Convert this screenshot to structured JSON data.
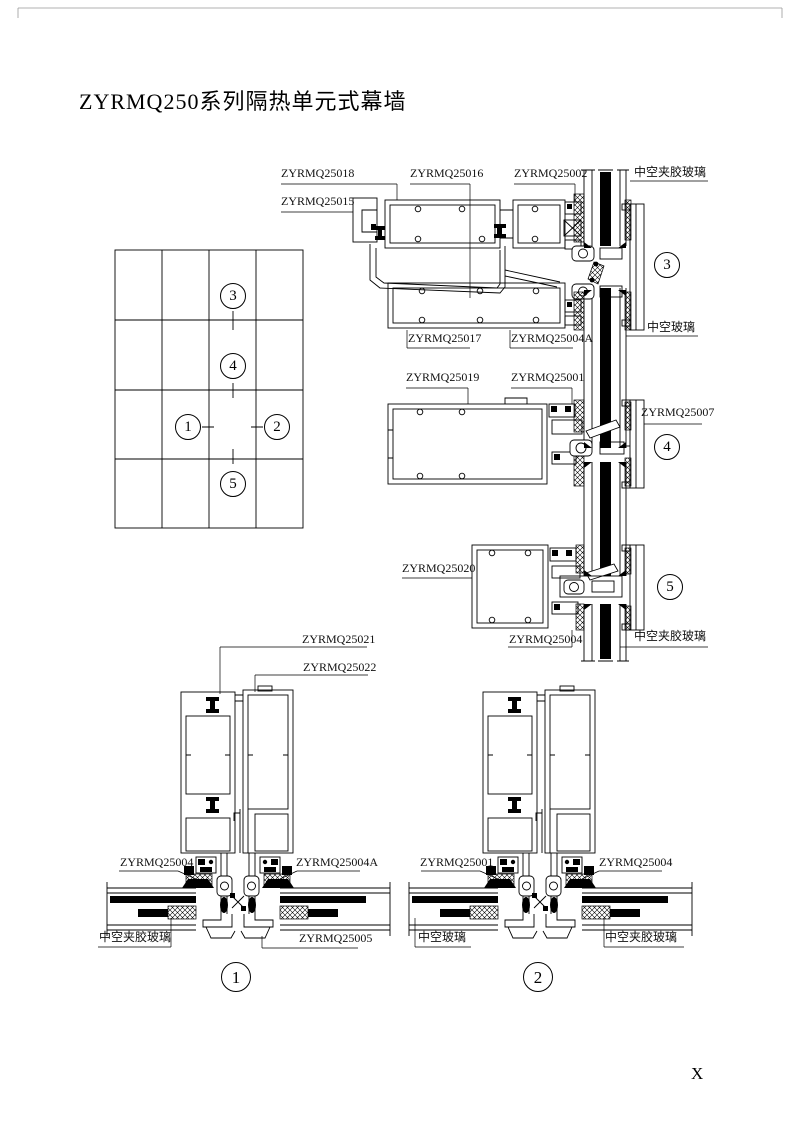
{
  "title": "ZYRMQ250系列隔热单元式幕墙",
  "page_marker": "X",
  "key_plan": {
    "markers": {
      "m1": "1",
      "m2": "2",
      "m3": "3",
      "m4": "4",
      "m5": "5"
    }
  },
  "detail_3": {
    "badge": "3",
    "part_labels": {
      "zyrmq25018": "ZYRMQ25018",
      "zyrmq25015": "ZYRMQ25015",
      "zyrmq25016": "ZYRMQ25016",
      "zyrmq25002": "ZYRMQ25002",
      "glass_top": "中空夹胶玻璃",
      "zyrmq25017": "ZYRMQ25017",
      "zyrmq25004a": "ZYRMQ25004A",
      "glass_bottom": "中空玻璃"
    }
  },
  "detail_4": {
    "badge": "4",
    "part_labels": {
      "zyrmq25019": "ZYRMQ25019",
      "zyrmq25001": "ZYRMQ25001",
      "zyrmq25007": "ZYRMQ25007"
    }
  },
  "detail_5": {
    "badge": "5",
    "part_labels": {
      "zyrmq25020": "ZYRMQ25020",
      "zyrmq25004": "ZYRMQ25004",
      "glass": "中空夹胶玻璃"
    }
  },
  "detail_1": {
    "badge": "1",
    "part_labels": {
      "zyrmq25021": "ZYRMQ25021",
      "zyrmq25022": "ZYRMQ25022",
      "zyrmq25004": "ZYRMQ25004",
      "zyrmq25004a": "ZYRMQ25004A",
      "glass_left": "中空夹胶玻璃",
      "zyrmq25005": "ZYRMQ25005"
    }
  },
  "detail_2": {
    "badge": "2",
    "part_labels": {
      "zyrmq25001": "ZYRMQ25001",
      "zyrmq25004": "ZYRMQ25004",
      "glass_left": "中空玻璃",
      "glass_right": "中空夹胶玻璃"
    }
  }
}
